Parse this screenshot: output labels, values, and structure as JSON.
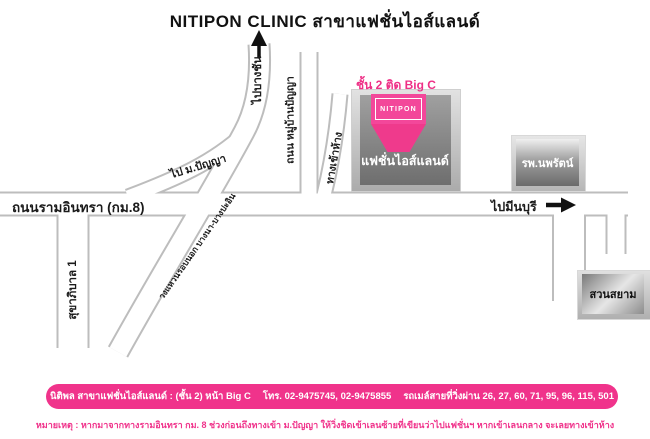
{
  "title": "NITIPON CLINIC สาขาแฟชั่นไอส์แลนด์",
  "colors": {
    "accent_pink": "#ef3a8c",
    "road_casing_gray": "#bdbdbd",
    "building_gray": "#8a8a8a"
  },
  "map": {
    "roads": {
      "ram_inthra_label": "ถนนรามอินทรา (กม.8)",
      "to_minburi_label": "ไปมีนบุรี",
      "sukhaphiban_label": "สุขาภิบาล 1",
      "to_bangchan_label": "ไปบางชัน",
      "muban_panya_label": "ถนน หมู่บ้านปัญญา",
      "to_panya_label": "ไป ม.ปัญญา",
      "ring_road_label": "วงแหวนรอบนอก บางนา-บางปะอิน",
      "mall_entrance_label": "ทางเข้าห้าง"
    },
    "places": {
      "floor_note": "ชั้น 2 ติด Big C",
      "clinic_logo": "NITIPON",
      "mall_name": "แฟชั่นไอส์แลนด์",
      "hospital": "รพ.นพรัตน์",
      "siam_park": "สวนสยาม"
    }
  },
  "footer": {
    "branch_info": "นิติพล สาขาแฟชั่นไอส์แลนด์ : (ชั้น 2) หน้า Big C",
    "phone": "โทร. 02-9475745, 02-9475855",
    "bus_lines": "รถเมล์สายที่วิ่งผ่าน 26, 27, 60, 71, 95, 96, 115, 501",
    "note": "หมายเหตุ : หากมาจากทางรามอินทรา กม. 8  ช่วงก่อนถึงทางเข้า ม.ปัญญา ให้วิ่งชิดเข้าเลนซ้ายที่เขียนว่าไปแฟชั่นฯ หากเข้าเลนกลาง จะเลยทางเข้าห้าง"
  }
}
